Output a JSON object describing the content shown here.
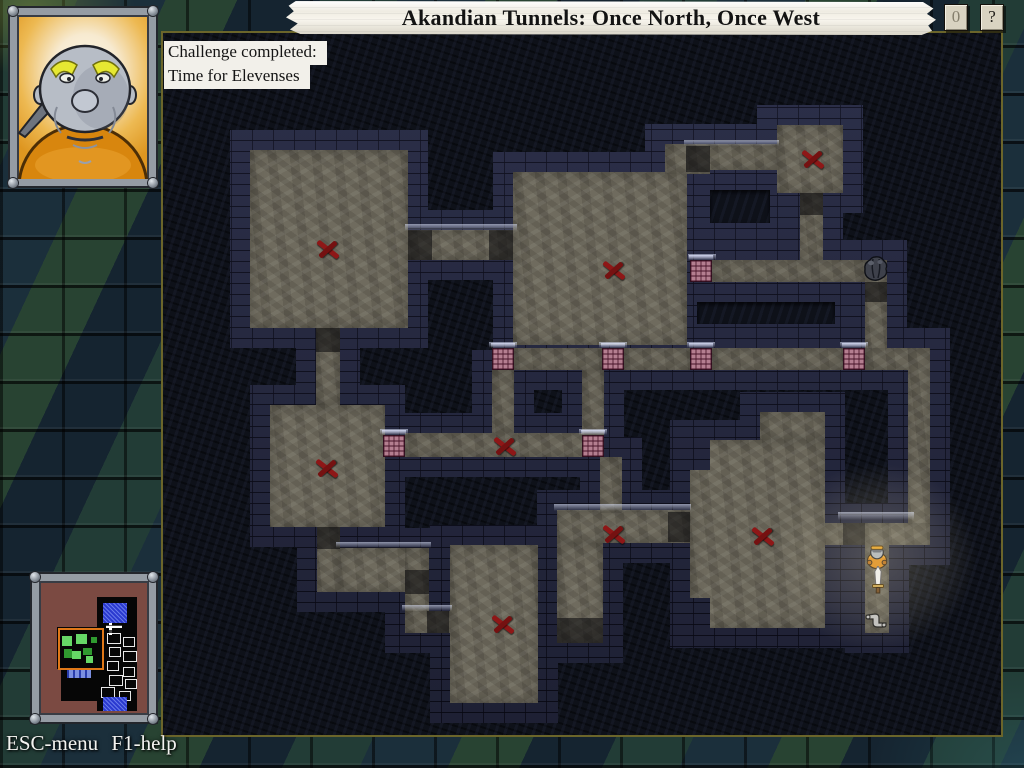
{
  "header": {
    "title": "Akandian Tunnels: Once North, Once West",
    "counter_label": "0",
    "help_label": "?"
  },
  "challenge": {
    "line1": "Challenge completed:",
    "line2": "Time for Elevenses"
  },
  "footer": {
    "help_text": "ESC-menu F1-help"
  },
  "palette": {
    "door_pink": "#b47e90",
    "mark_red": "#8e1717",
    "wall_brick": "#252840",
    "floor_stone": "#6f6b5e",
    "banner_parchment": "#f3f0e8",
    "area_border_olive": "#6b652a",
    "minimap_bg": "#7b4a42",
    "minimap_green_bright": "#66d866",
    "minimap_green_dark": "#2f9a2f",
    "minimap_select_orange": "#e07818",
    "minimap_room_blue": "#2b3ad0"
  },
  "map": {
    "floors": [
      [
        250,
        150,
        158,
        178
      ],
      [
        513,
        172,
        174,
        173
      ],
      [
        665,
        144,
        45,
        30
      ],
      [
        777,
        125,
        66,
        68
      ],
      [
        270,
        405,
        115,
        122
      ],
      [
        450,
        545,
        88,
        158
      ],
      [
        557,
        543,
        46,
        100
      ],
      [
        557,
        510,
        133,
        33
      ],
      [
        690,
        440,
        135,
        188
      ],
      [
        760,
        412,
        65,
        28
      ],
      [
        408,
        230,
        105,
        30
      ],
      [
        316,
        328,
        24,
        77
      ],
      [
        686,
        144,
        91,
        26
      ],
      [
        800,
        193,
        23,
        70
      ],
      [
        712,
        260,
        153,
        22
      ],
      [
        865,
        260,
        22,
        110
      ],
      [
        514,
        348,
        88,
        22
      ],
      [
        624,
        348,
        66,
        22
      ],
      [
        712,
        348,
        131,
        22
      ],
      [
        865,
        348,
        65,
        22
      ],
      [
        908,
        348,
        22,
        197
      ],
      [
        825,
        523,
        105,
        22
      ],
      [
        865,
        523,
        24,
        110
      ],
      [
        492,
        370,
        22,
        65
      ],
      [
        582,
        370,
        22,
        65
      ],
      [
        405,
        433,
        199,
        24
      ],
      [
        600,
        457,
        22,
        56
      ],
      [
        317,
        527,
        23,
        65
      ],
      [
        340,
        548,
        87,
        44
      ],
      [
        405,
        548,
        24,
        85
      ],
      [
        405,
        611,
        45,
        22
      ]
    ],
    "enclosures": [
      {
        "outer": [
          688,
          168,
          104,
          77
        ],
        "inner": [
          710,
          190,
          60,
          33
        ]
      },
      {
        "outer": [
          675,
          282,
          182,
          60
        ],
        "inner": [
          697,
          302,
          138,
          22
        ]
      }
    ],
    "notches": [
      [
        690,
        440,
        20,
        30
      ],
      [
        690,
        598,
        20,
        30
      ]
    ],
    "shadows": [
      [
        408,
        230,
        24,
        30
      ],
      [
        489,
        230,
        24,
        30
      ],
      [
        316,
        328,
        24,
        24
      ],
      [
        686,
        146,
        24,
        26
      ],
      [
        800,
        193,
        23,
        22
      ],
      [
        865,
        282,
        22,
        20
      ],
      [
        843,
        523,
        22,
        22
      ],
      [
        317,
        527,
        23,
        22
      ],
      [
        405,
        570,
        24,
        24
      ],
      [
        427,
        611,
        22,
        22
      ],
      [
        668,
        512,
        22,
        30
      ],
      [
        557,
        618,
        46,
        25
      ]
    ],
    "glints": [
      [
        405,
        224,
        112,
        7
      ],
      [
        684,
        140,
        95,
        6
      ],
      [
        688,
        254,
        28,
        6
      ],
      [
        489,
        342,
        28,
        6
      ],
      [
        599,
        342,
        28,
        6
      ],
      [
        687,
        342,
        28,
        6
      ],
      [
        840,
        342,
        28,
        6
      ],
      [
        380,
        429,
        28,
        6
      ],
      [
        579,
        429,
        28,
        6
      ],
      [
        838,
        512,
        76,
        8
      ],
      [
        336,
        542,
        95,
        6
      ],
      [
        554,
        504,
        137,
        7
      ],
      [
        402,
        605,
        50,
        6
      ]
    ],
    "doors": [
      [
        690,
        260
      ],
      [
        492,
        348
      ],
      [
        602,
        348
      ],
      [
        690,
        348
      ],
      [
        843,
        348
      ],
      [
        383,
        435
      ],
      [
        582,
        435
      ]
    ],
    "marks": [
      [
        328,
        249
      ],
      [
        614,
        270
      ],
      [
        813,
        159
      ],
      [
        327,
        468
      ],
      [
        505,
        446
      ],
      [
        614,
        534
      ],
      [
        503,
        624
      ],
      [
        763,
        536
      ]
    ],
    "items": {
      "rock": {
        "x": 862,
        "y": 255
      },
      "player": {
        "x": 866,
        "y": 545
      },
      "sword": {
        "x": 870,
        "y": 566
      },
      "scroll": {
        "x": 864,
        "y": 610
      }
    }
  },
  "minimap": {
    "blacks": [
      [
        58,
        16,
        40,
        36
      ],
      [
        58,
        52,
        40,
        78
      ],
      [
        18,
        46,
        44,
        42
      ],
      [
        22,
        84,
        36,
        36
      ]
    ],
    "blues": [
      [
        64,
        22,
        24,
        20
      ],
      [
        64,
        116,
        24,
        14
      ]
    ],
    "bars": [
      [
        28,
        88,
        24,
        9
      ]
    ],
    "select": [
      19,
      47,
      42,
      38
    ],
    "greens": [
      [
        23,
        55,
        10,
        10,
        "b"
      ],
      [
        37,
        53,
        11,
        10,
        "b"
      ],
      [
        52,
        56,
        6,
        6,
        "d"
      ],
      [
        25,
        68,
        8,
        9,
        "d"
      ],
      [
        33,
        70,
        9,
        8,
        "b"
      ],
      [
        44,
        67,
        9,
        7,
        "d"
      ],
      [
        47,
        75,
        7,
        7,
        "b"
      ]
    ],
    "whites": [
      [
        68,
        52,
        12,
        9
      ],
      [
        84,
        56,
        10,
        8
      ],
      [
        70,
        66,
        10,
        8
      ],
      [
        84,
        70,
        12,
        9
      ],
      [
        68,
        80,
        10,
        8
      ],
      [
        84,
        86,
        10,
        8
      ],
      [
        70,
        94,
        12,
        9
      ],
      [
        86,
        98,
        10,
        8
      ],
      [
        62,
        106,
        12,
        9
      ],
      [
        80,
        110,
        10,
        8
      ]
    ],
    "deco": [
      [
        70,
        28,
        3,
        26
      ],
      [
        67,
        44,
        16,
        3
      ]
    ]
  }
}
